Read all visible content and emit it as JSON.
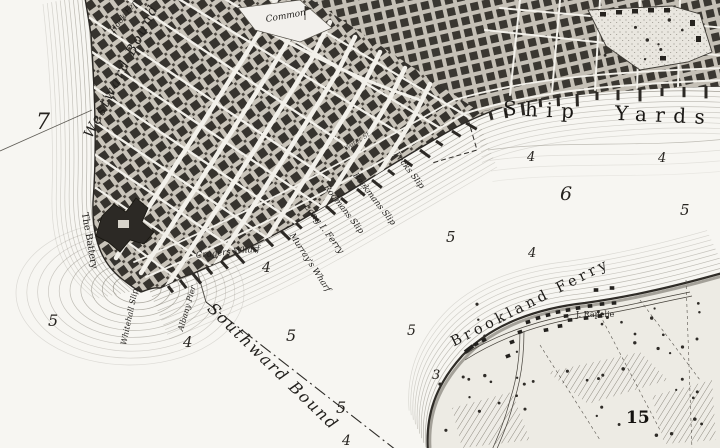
{
  "map": {
    "labels": {
      "ship_yards": "Ship Yards",
      "brookland_ferry": "Brookland Ferry",
      "southward_bound": "Southward Bound",
      "westward_bound": "Westward Bound",
      "hook_ferry": "Hook Ferry",
      "long_island_ferry": "Long I. Ferry",
      "murrays_wharf": "Murray's Wharf",
      "rodmans_slip": "Rodmans Slip",
      "beekmans_slip": "Beekmans Slip",
      "pecks_slip": "Pecks Slip",
      "crugers_wharf": "Crugers Wharf",
      "whitehall_slip": "Whitehall Slip",
      "albany_pier": "Albany Pier",
      "the_battery": "The Battery",
      "common": "Common",
      "water_st": "Water St.",
      "j_rapelje": "J. Rapelje",
      "parcel_number": "15"
    },
    "soundings": [
      {
        "v": "7"
      },
      {
        "v": "5"
      },
      {
        "v": "4"
      },
      {
        "v": "4"
      },
      {
        "v": "5"
      },
      {
        "v": "5"
      },
      {
        "v": "5"
      },
      {
        "v": "4"
      },
      {
        "v": "6"
      },
      {
        "v": "4"
      },
      {
        "v": "5"
      },
      {
        "v": "3"
      },
      {
        "v": "5"
      },
      {
        "v": "4"
      },
      {
        "v": "4"
      }
    ],
    "colors": {
      "paper": "#f7f6f2",
      "ink": "#26231f",
      "hachure": "#8d897f",
      "block_fill": "#36332e"
    }
  }
}
